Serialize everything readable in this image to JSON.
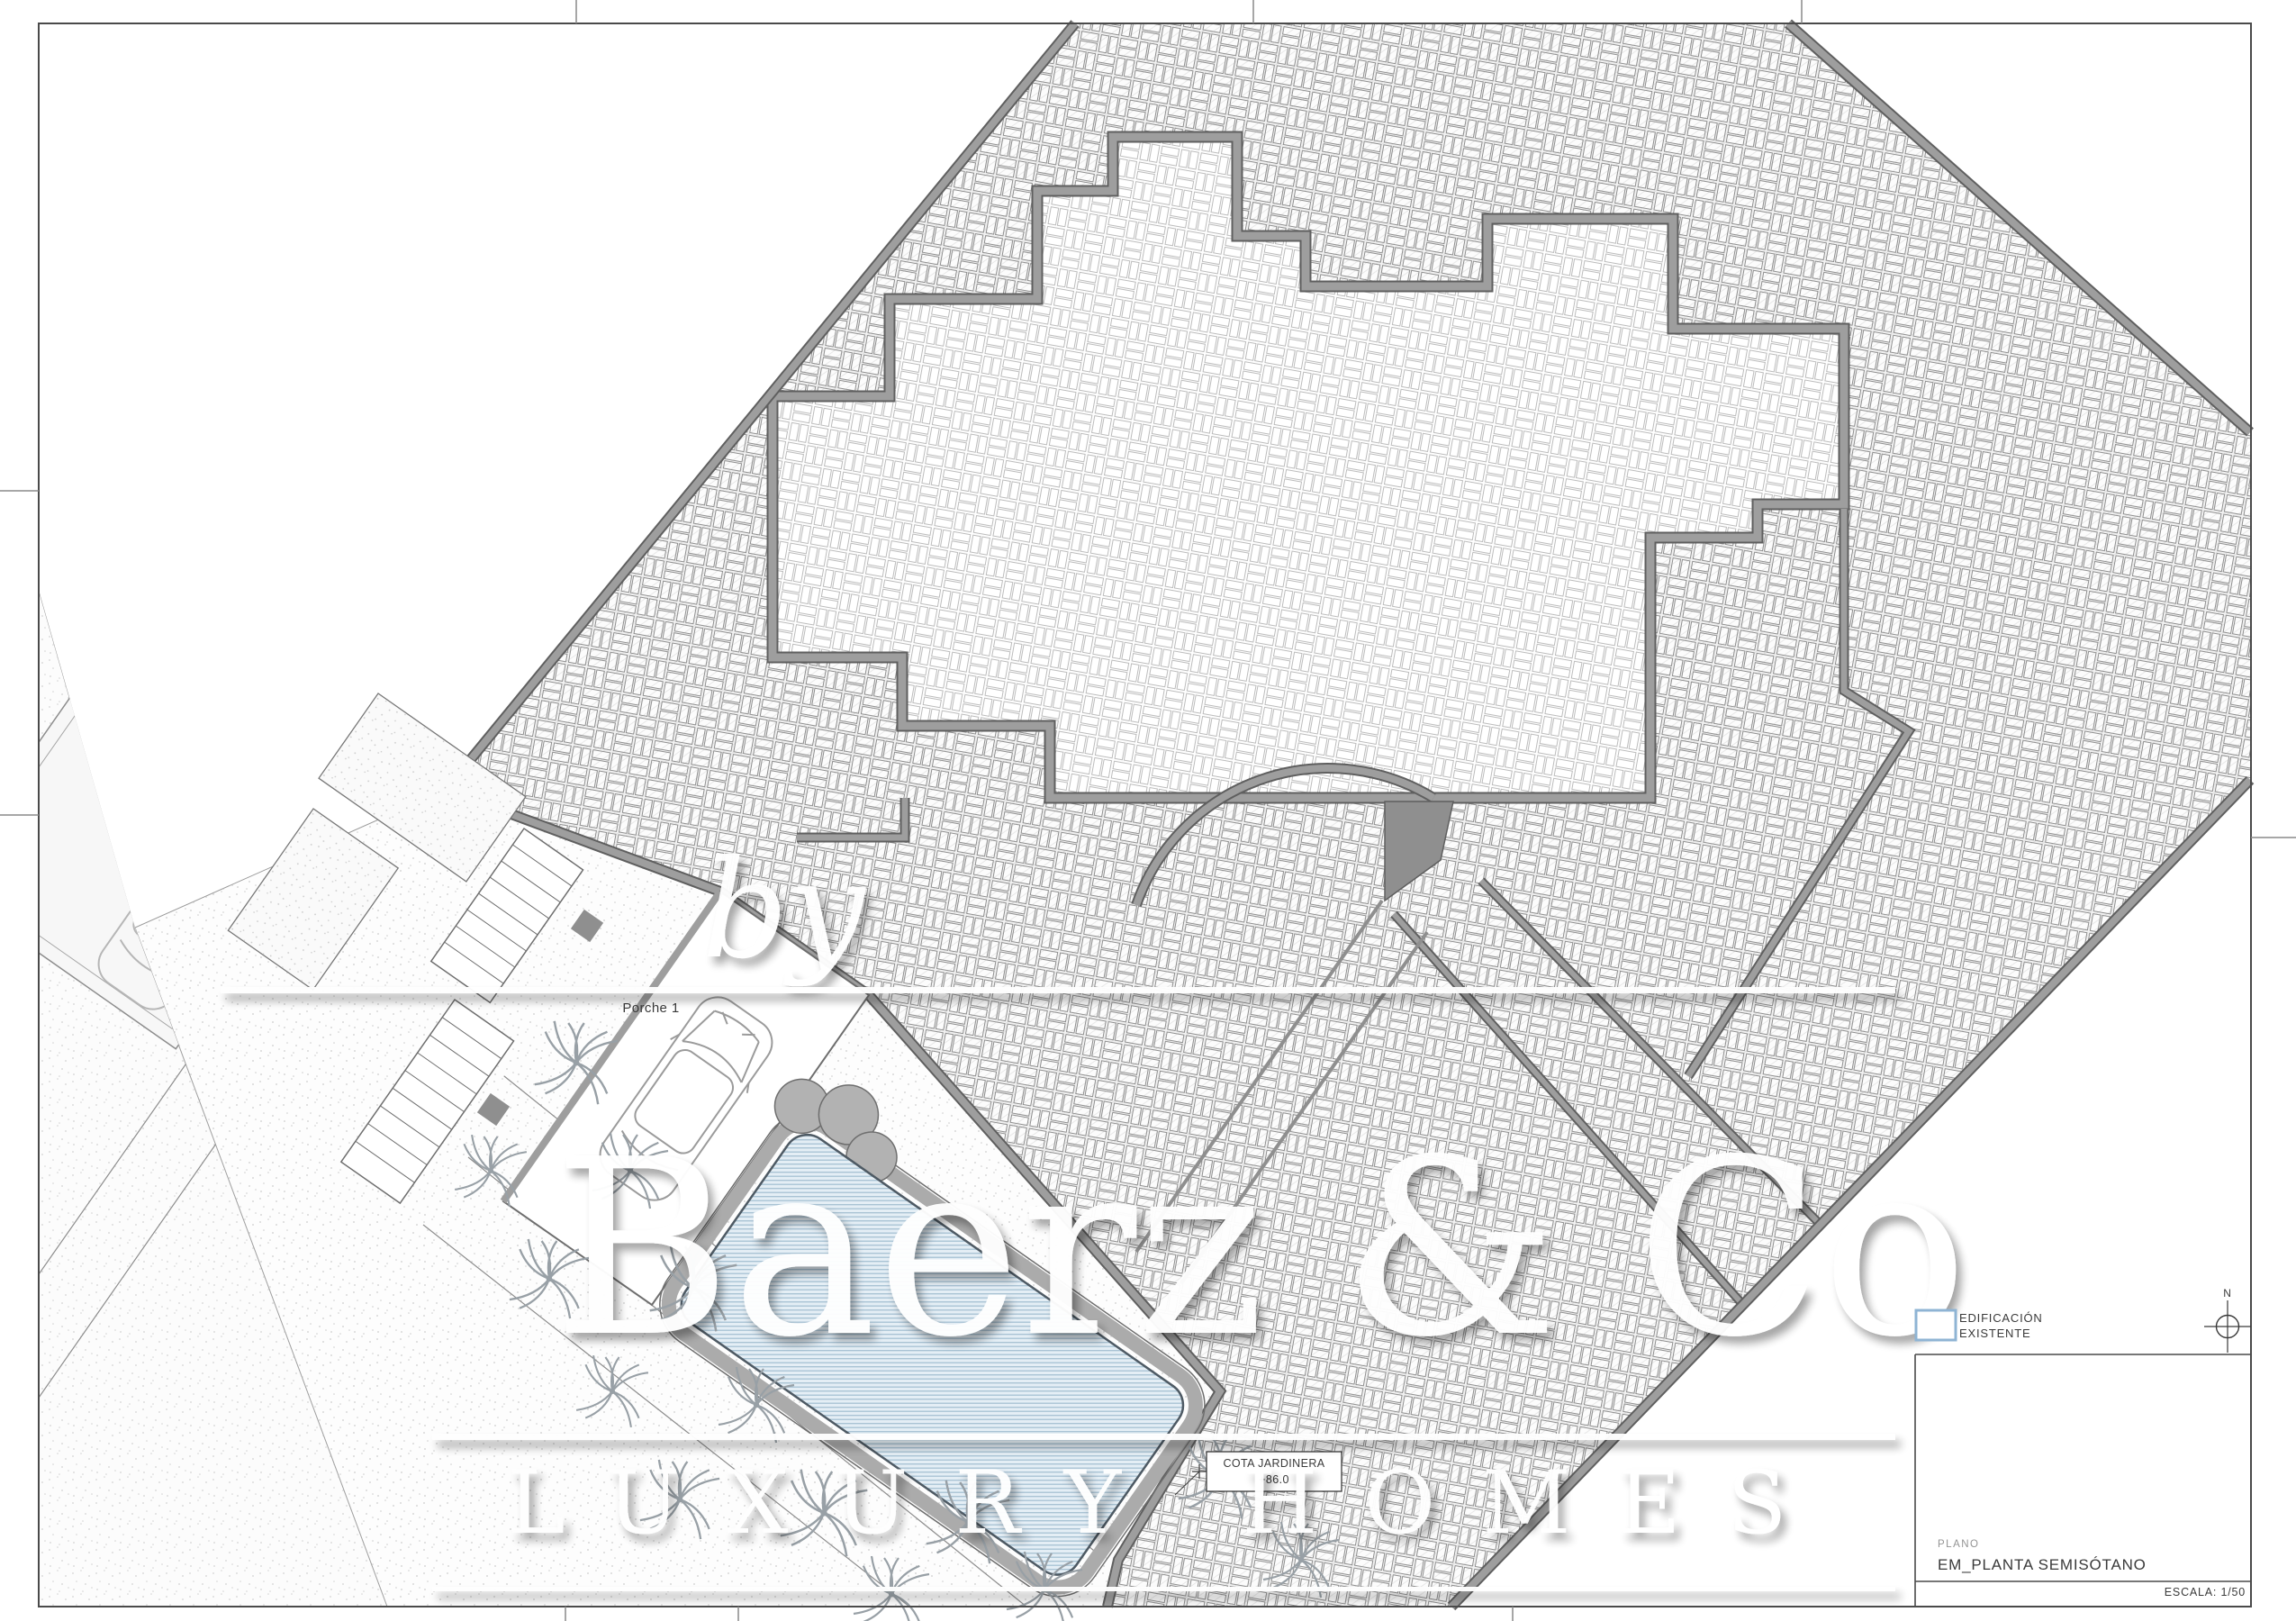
{
  "page": {
    "background": "#ffffff",
    "frame_color": "#4a4a4a"
  },
  "plan": {
    "labels": {
      "porch": "Porche 1",
      "cota_line1": "COTA JARDINERA",
      "cota_line2": "+86.0"
    },
    "colors": {
      "paving_hatch": "#8f8f8f",
      "wall_gray": "#9e9e9e",
      "wall_edge": "#5f5f5f",
      "pool_fill": "#e4eef5",
      "pool_stripe": "#a6c1d3"
    }
  },
  "watermark": {
    "by": "by",
    "brand": "Baerz & Co",
    "tagline": "LUXURY HOMES"
  },
  "legend": {
    "swatch_color": "#8fb4d4",
    "line1": "EDIFICACIÓN",
    "line2": "EXISTENTE"
  },
  "north": {
    "label": "N"
  },
  "title_block": {
    "field_label": "PLANO",
    "drawing_title": "EM_PLANTA SEMISÓTANO",
    "scale": "ESCALA: 1/50"
  }
}
